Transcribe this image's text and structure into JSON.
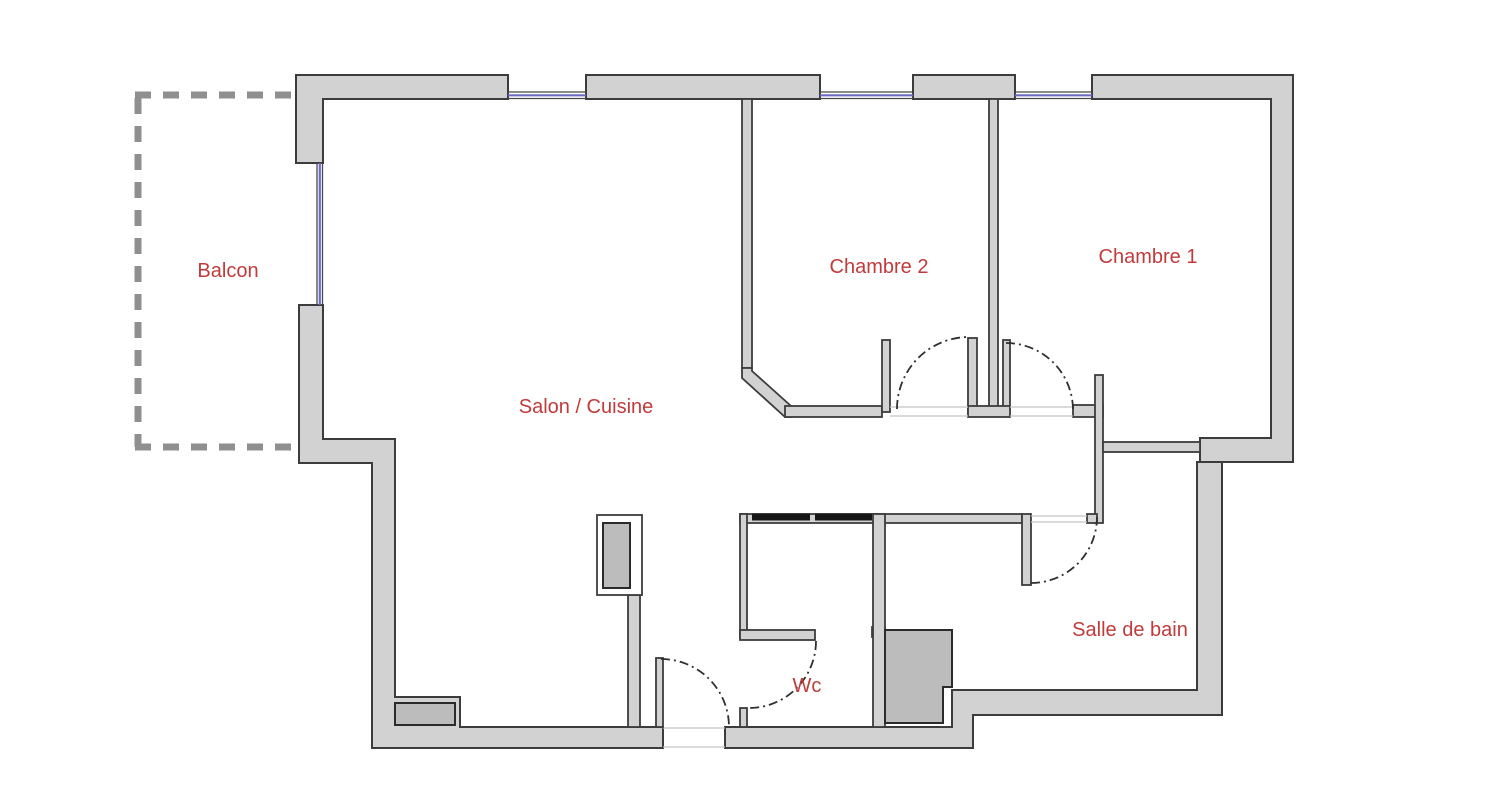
{
  "plan": {
    "rooms": [
      {
        "id": "balcon",
        "label": "Balcon"
      },
      {
        "id": "salon-cuisine",
        "label": "Salon / Cuisine"
      },
      {
        "id": "chambre-2",
        "label": "Chambre 2"
      },
      {
        "id": "chambre-1",
        "label": "Chambre 1"
      },
      {
        "id": "salle-de-bain",
        "label": "Salle de bain"
      },
      {
        "id": "wc",
        "label": "Wc"
      }
    ],
    "colors": {
      "background": "#ffffff",
      "wall_fill": "#d2d2d2",
      "wall_outline": "#3c3c3c",
      "window_blue": "#6b6bc4",
      "label_red": "#c13b3b",
      "balcony_dash_gray": "#8f8f8f",
      "fixture_gray": "#bcbcbc",
      "counter_black": "#161616"
    }
  }
}
